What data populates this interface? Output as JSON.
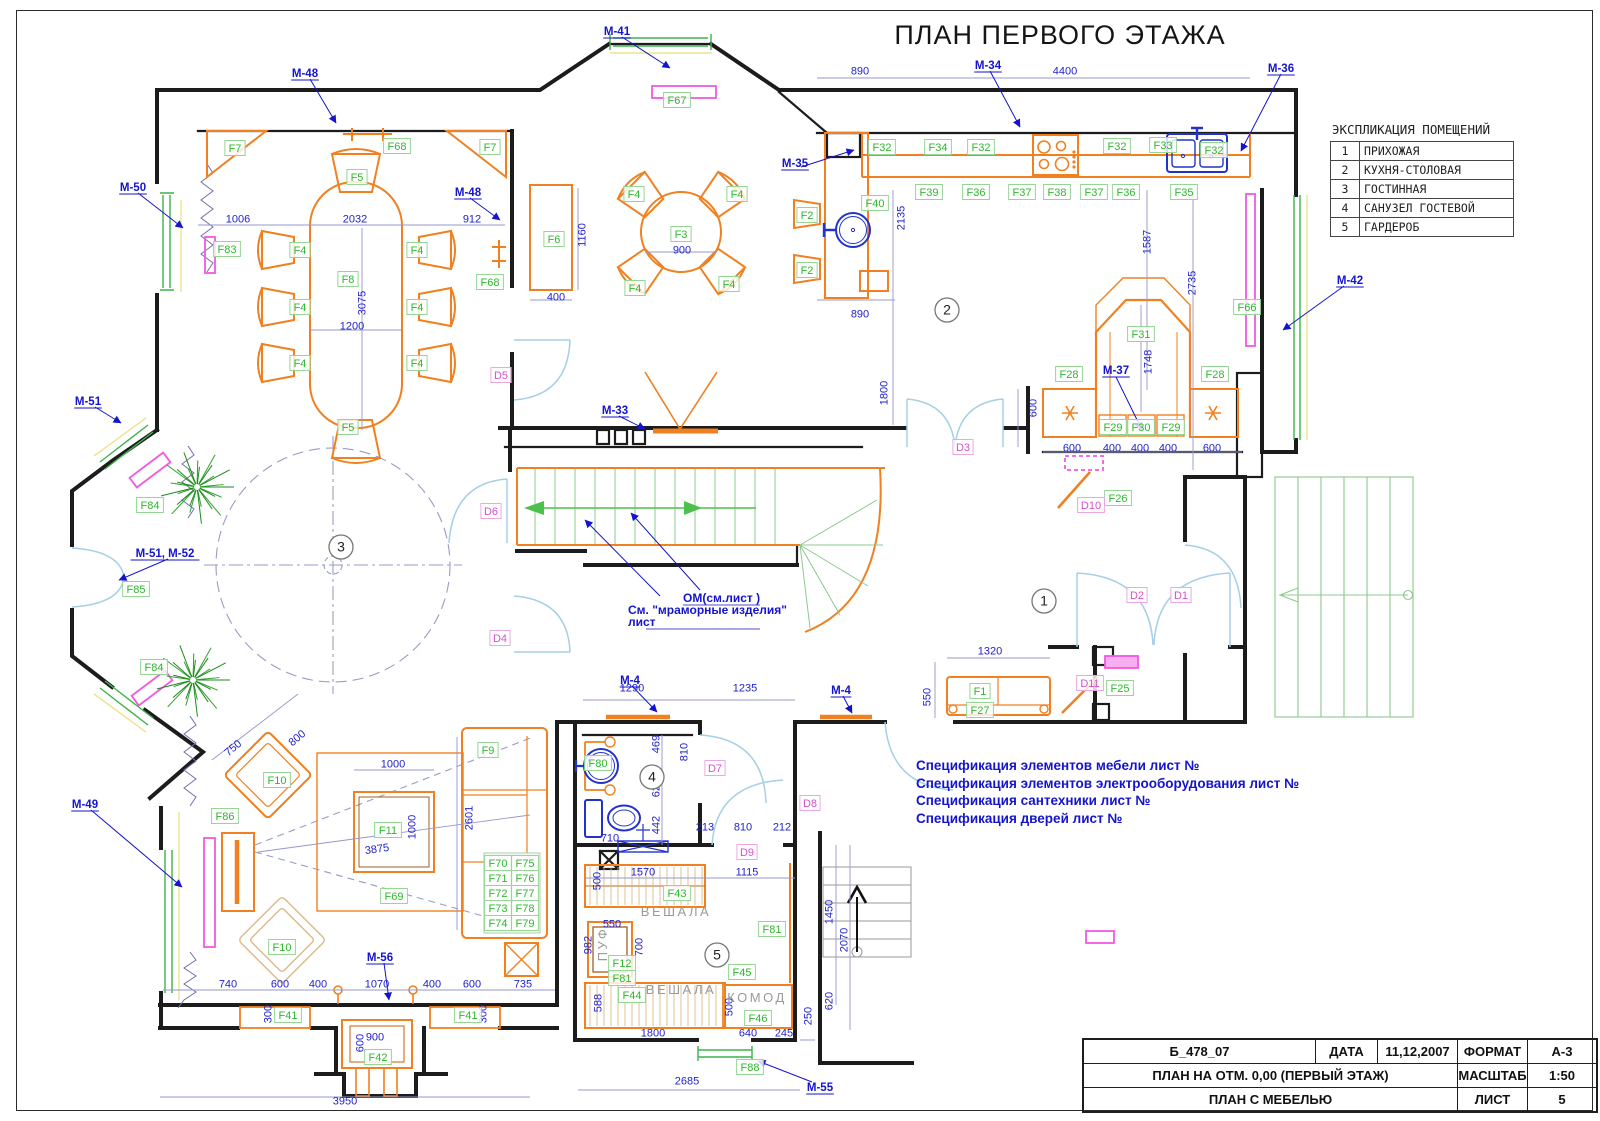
{
  "title": "ПЛАН ПЕРВОГО ЭТАЖА",
  "legend": {
    "title": "ЭКСПЛИКАЦИЯ ПОМЕЩЕНИЙ",
    "rows": [
      [
        "1",
        "ПРИХОЖАЯ"
      ],
      [
        "2",
        "КУХНЯ-СТОЛОВАЯ"
      ],
      [
        "3",
        "ГОСТИННАЯ"
      ],
      [
        "4",
        "САНУЗЕЛ ГОСТЕВОЙ"
      ],
      [
        "5",
        "ГАРДЕРОБ"
      ]
    ]
  },
  "title_block": {
    "doc_code": "Б_478_07",
    "date_label": "ДАТА",
    "date_value": "11,12,2007",
    "format_label": "ФОРМАТ",
    "format_value": "А-3",
    "plan_title": "ПЛАН НА ОТМ. 0,00 (ПЕРВЫЙ ЭТАЖ)",
    "scale_label": "МАСШТАБ",
    "scale_value": "1:50",
    "sheet_title": "ПЛАН С МЕБЕЛЬЮ",
    "sheet_label": "ЛИСТ",
    "sheet_value": "5"
  },
  "notes": [
    "Спецификация элементов мебели лист №",
    "Спецификация элементов электрооборудования лист №",
    "Спецификация сантехники лист №",
    "Спецификация дверей лист №"
  ],
  "stair_annotation": [
    {
      "t": "ОМ(см.лист    )",
      "x": 683,
      "y": 602,
      "u": true
    },
    {
      "t": "См. \"мраморные изделия\"",
      "x": 628,
      "y": 614,
      "u": false
    },
    {
      "t": "лист",
      "x": 628,
      "y": 626,
      "u": true
    }
  ],
  "room_numbers": [
    [
      "1",
      1044,
      601
    ],
    [
      "2",
      947,
      310
    ],
    [
      "3",
      341,
      547
    ],
    [
      "4",
      652,
      777
    ],
    [
      "5",
      717,
      955
    ]
  ],
  "f_labels": [
    [
      "F7",
      235,
      148
    ],
    [
      "F68",
      397,
      146
    ],
    [
      "F7",
      490,
      147
    ],
    [
      "F5",
      357,
      177
    ],
    [
      "F83",
      227,
      249
    ],
    [
      "F4",
      300,
      250
    ],
    [
      "F4",
      417,
      250
    ],
    [
      "F8",
      348,
      279
    ],
    [
      "F4",
      300,
      307
    ],
    [
      "F4",
      417,
      307
    ],
    [
      "F4",
      300,
      363
    ],
    [
      "F4",
      417,
      363
    ],
    [
      "F5",
      348,
      427
    ],
    [
      "F68",
      490,
      282
    ],
    [
      "F6",
      554,
      239
    ],
    [
      "F3",
      681,
      234
    ],
    [
      "F4",
      634,
      194
    ],
    [
      "F4",
      737,
      194
    ],
    [
      "F4",
      635,
      288
    ],
    [
      "F4",
      729,
      284
    ],
    [
      "F67",
      677,
      100
    ],
    [
      "F2",
      807,
      215
    ],
    [
      "F2",
      807,
      270
    ],
    [
      "F40",
      875,
      203
    ],
    [
      "F32",
      882,
      147
    ],
    [
      "F34",
      938,
      147
    ],
    [
      "F32",
      981,
      147
    ],
    [
      "F32",
      1117,
      146
    ],
    [
      "F33",
      1163,
      145
    ],
    [
      "F32",
      1214,
      150
    ],
    [
      "F39",
      929,
      192
    ],
    [
      "F36",
      976,
      192
    ],
    [
      "F37",
      1022,
      192
    ],
    [
      "F38",
      1057,
      192
    ],
    [
      "F37",
      1094,
      192
    ],
    [
      "F36",
      1126,
      192
    ],
    [
      "F35",
      1184,
      192
    ],
    [
      "F31",
      1141,
      334
    ],
    [
      "F28",
      1069,
      374
    ],
    [
      "F28",
      1215,
      374
    ],
    [
      "F29",
      1113,
      427
    ],
    [
      "F30",
      1141,
      427
    ],
    [
      "F29",
      1171,
      427
    ],
    [
      "F66",
      1247,
      307
    ],
    [
      "F26",
      1118,
      498
    ],
    [
      "F25",
      1120,
      688
    ],
    [
      "F1",
      980,
      691
    ],
    [
      "F27",
      980,
      710
    ],
    [
      "F80",
      598,
      763
    ],
    [
      "F9",
      488,
      750
    ],
    [
      "F11",
      388,
      830
    ],
    [
      "F69",
      394,
      896
    ],
    [
      "F10",
      277,
      780
    ],
    [
      "F10",
      282,
      947
    ],
    [
      "F86",
      225,
      816
    ],
    [
      "F84",
      150,
      505
    ],
    [
      "F84",
      154,
      667
    ],
    [
      "F85",
      136,
      589
    ],
    [
      "F70",
      498,
      863
    ],
    [
      "F75",
      525,
      863
    ],
    [
      "F71",
      498,
      878
    ],
    [
      "F76",
      525,
      878
    ],
    [
      "F72",
      498,
      893
    ],
    [
      "F77",
      525,
      893
    ],
    [
      "F73",
      498,
      908
    ],
    [
      "F78",
      525,
      908
    ],
    [
      "F74",
      498,
      923
    ],
    [
      "F79",
      525,
      923
    ],
    [
      "F43",
      677,
      893
    ],
    [
      "F12",
      622,
      963
    ],
    [
      "F81",
      622,
      978
    ],
    [
      "F81",
      772,
      929
    ],
    [
      "F45",
      742,
      972
    ],
    [
      "F44",
      632,
      995
    ],
    [
      "F46",
      758,
      1018
    ],
    [
      "F88",
      750,
      1067
    ],
    [
      "F41",
      288,
      1015
    ],
    [
      "F41",
      468,
      1015
    ],
    [
      "F42",
      378,
      1057
    ]
  ],
  "d_labels": [
    [
      "D1",
      1181,
      595
    ],
    [
      "D2",
      1137,
      595
    ],
    [
      "D3",
      963,
      447
    ],
    [
      "D4",
      500,
      638
    ],
    [
      "D5",
      501,
      375
    ],
    [
      "D6",
      491,
      511
    ],
    [
      "D7",
      715,
      768
    ],
    [
      "D8",
      810,
      803
    ],
    [
      "D9",
      747,
      852
    ],
    [
      "D10",
      1091,
      505
    ],
    [
      "D11",
      1090,
      683
    ]
  ],
  "m_labels": [
    [
      "М-41",
      617,
      31
    ],
    [
      "М-48",
      305,
      73
    ],
    [
      "М-48",
      468,
      192
    ],
    [
      "М-50",
      133,
      187
    ],
    [
      "М-34",
      988,
      65
    ],
    [
      "М-35",
      795,
      163
    ],
    [
      "М-36",
      1281,
      68
    ],
    [
      "М-42",
      1350,
      280
    ],
    [
      "М-37",
      1116,
      370
    ],
    [
      "М-33",
      615,
      410
    ],
    [
      "М-51",
      88,
      401
    ],
    [
      "М-51, М-52",
      165,
      553
    ],
    [
      "М-49",
      85,
      804
    ],
    [
      "М-56",
      380,
      957
    ],
    [
      "М-55",
      820,
      1087
    ],
    [
      "М-4",
      630,
      680
    ],
    [
      "М-4",
      841,
      690
    ]
  ],
  "dims": [
    [
      "1006",
      238,
      219,
      0
    ],
    [
      "2032",
      355,
      219,
      0
    ],
    [
      "912",
      472,
      219,
      0
    ],
    [
      "3075",
      362,
      303,
      -90
    ],
    [
      "1200",
      352,
      326,
      0
    ],
    [
      "1160",
      582,
      235,
      -90
    ],
    [
      "400",
      556,
      297,
      0
    ],
    [
      "900",
      682,
      250,
      0
    ],
    [
      "890",
      860,
      71,
      0
    ],
    [
      "4400",
      1065,
      71,
      0
    ],
    [
      "2135",
      901,
      218,
      -90
    ],
    [
      "890",
      860,
      314,
      0
    ],
    [
      "1800",
      884,
      393,
      -90
    ],
    [
      "1587",
      1147,
      242,
      -90
    ],
    [
      "2735",
      1192,
      283,
      -90
    ],
    [
      "1748",
      1148,
      362,
      -90
    ],
    [
      "600",
      1033,
      408,
      -90
    ],
    [
      "600",
      1072,
      448,
      0
    ],
    [
      "400",
      1112,
      448,
      0
    ],
    [
      "400",
      1140,
      448,
      0
    ],
    [
      "400",
      1168,
      448,
      0
    ],
    [
      "600",
      1212,
      448,
      0
    ],
    [
      "1320",
      990,
      651,
      0
    ],
    [
      "550",
      927,
      697,
      -90
    ],
    [
      "1290",
      632,
      688,
      0
    ],
    [
      "1235",
      745,
      688,
      0
    ],
    [
      "469",
      656,
      744,
      -90
    ],
    [
      "810",
      684,
      752,
      -90
    ],
    [
      "629",
      656,
      788,
      -90
    ],
    [
      "442",
      656,
      825,
      -90
    ],
    [
      "710",
      610,
      838,
      0
    ],
    [
      "213",
      705,
      827,
      0
    ],
    [
      "810",
      743,
      827,
      0
    ],
    [
      "212",
      782,
      827,
      0
    ],
    [
      "500",
      597,
      881,
      -90
    ],
    [
      "1570",
      643,
      872,
      0
    ],
    [
      "1115",
      747,
      872,
      0
    ],
    [
      "550",
      612,
      924,
      0
    ],
    [
      "982",
      588,
      945,
      -90
    ],
    [
      "700",
      639,
      947,
      -90
    ],
    [
      "588",
      598,
      1003,
      -90
    ],
    [
      "500",
      729,
      1007,
      -90
    ],
    [
      "1800",
      653,
      1033,
      0
    ],
    [
      "640",
      748,
      1033,
      0
    ],
    [
      "245",
      784,
      1033,
      0
    ],
    [
      "2685",
      687,
      1081,
      0
    ],
    [
      "1450",
      829,
      912,
      -90
    ],
    [
      "2070",
      844,
      940,
      -90
    ],
    [
      "620",
      829,
      1001,
      -90
    ],
    [
      "250",
      808,
      1016,
      -90
    ],
    [
      "750",
      233,
      748,
      -40
    ],
    [
      "800",
      297,
      738,
      -40
    ],
    [
      "1000",
      393,
      764,
      0
    ],
    [
      "1000",
      412,
      827,
      -90
    ],
    [
      "3875",
      377,
      849,
      -8
    ],
    [
      "2601",
      469,
      818,
      -90
    ],
    [
      "740",
      228,
      984,
      0
    ],
    [
      "600",
      280,
      984,
      0
    ],
    [
      "400",
      318,
      984,
      0
    ],
    [
      "1070",
      377,
      984,
      0
    ],
    [
      "400",
      432,
      984,
      0
    ],
    [
      "600",
      472,
      984,
      0
    ],
    [
      "735",
      523,
      984,
      0
    ],
    [
      "300",
      268,
      1014,
      -90
    ],
    [
      "300",
      483,
      1014,
      -90
    ],
    [
      "900",
      375,
      1037,
      0
    ],
    [
      "600",
      360,
      1043,
      -90
    ],
    [
      "3950",
      345,
      1101,
      0
    ]
  ],
  "room_texts": [
    [
      "ВЕШАЛА",
      676,
      916,
      0
    ],
    [
      "ВЕШАЛА",
      681,
      994,
      0
    ],
    [
      "ПУФ",
      607,
      944,
      -90
    ],
    [
      "КОМОД",
      757,
      1002,
      0
    ]
  ],
  "plants": [
    {
      "x": 197,
      "y": 487,
      "r": 37
    },
    {
      "x": 193,
      "y": 680,
      "r": 37
    }
  ],
  "colors": {
    "wall": "#1c1c1c",
    "furniture": "#f08020",
    "label_green": "#2db82d",
    "label_magenta": "#d84fd0",
    "blue_text": "#1414cc",
    "dim_blue": "#2222cc",
    "window_green": "#3cb44a",
    "stair_green": "#8cc88c",
    "door_cyan": "#a5cfe6",
    "radiator_pink": "#f05ae0",
    "sanitary_blue": "#2233cc",
    "plant_green": "#2ca02c",
    "gray_text": "#9a9a9a"
  }
}
